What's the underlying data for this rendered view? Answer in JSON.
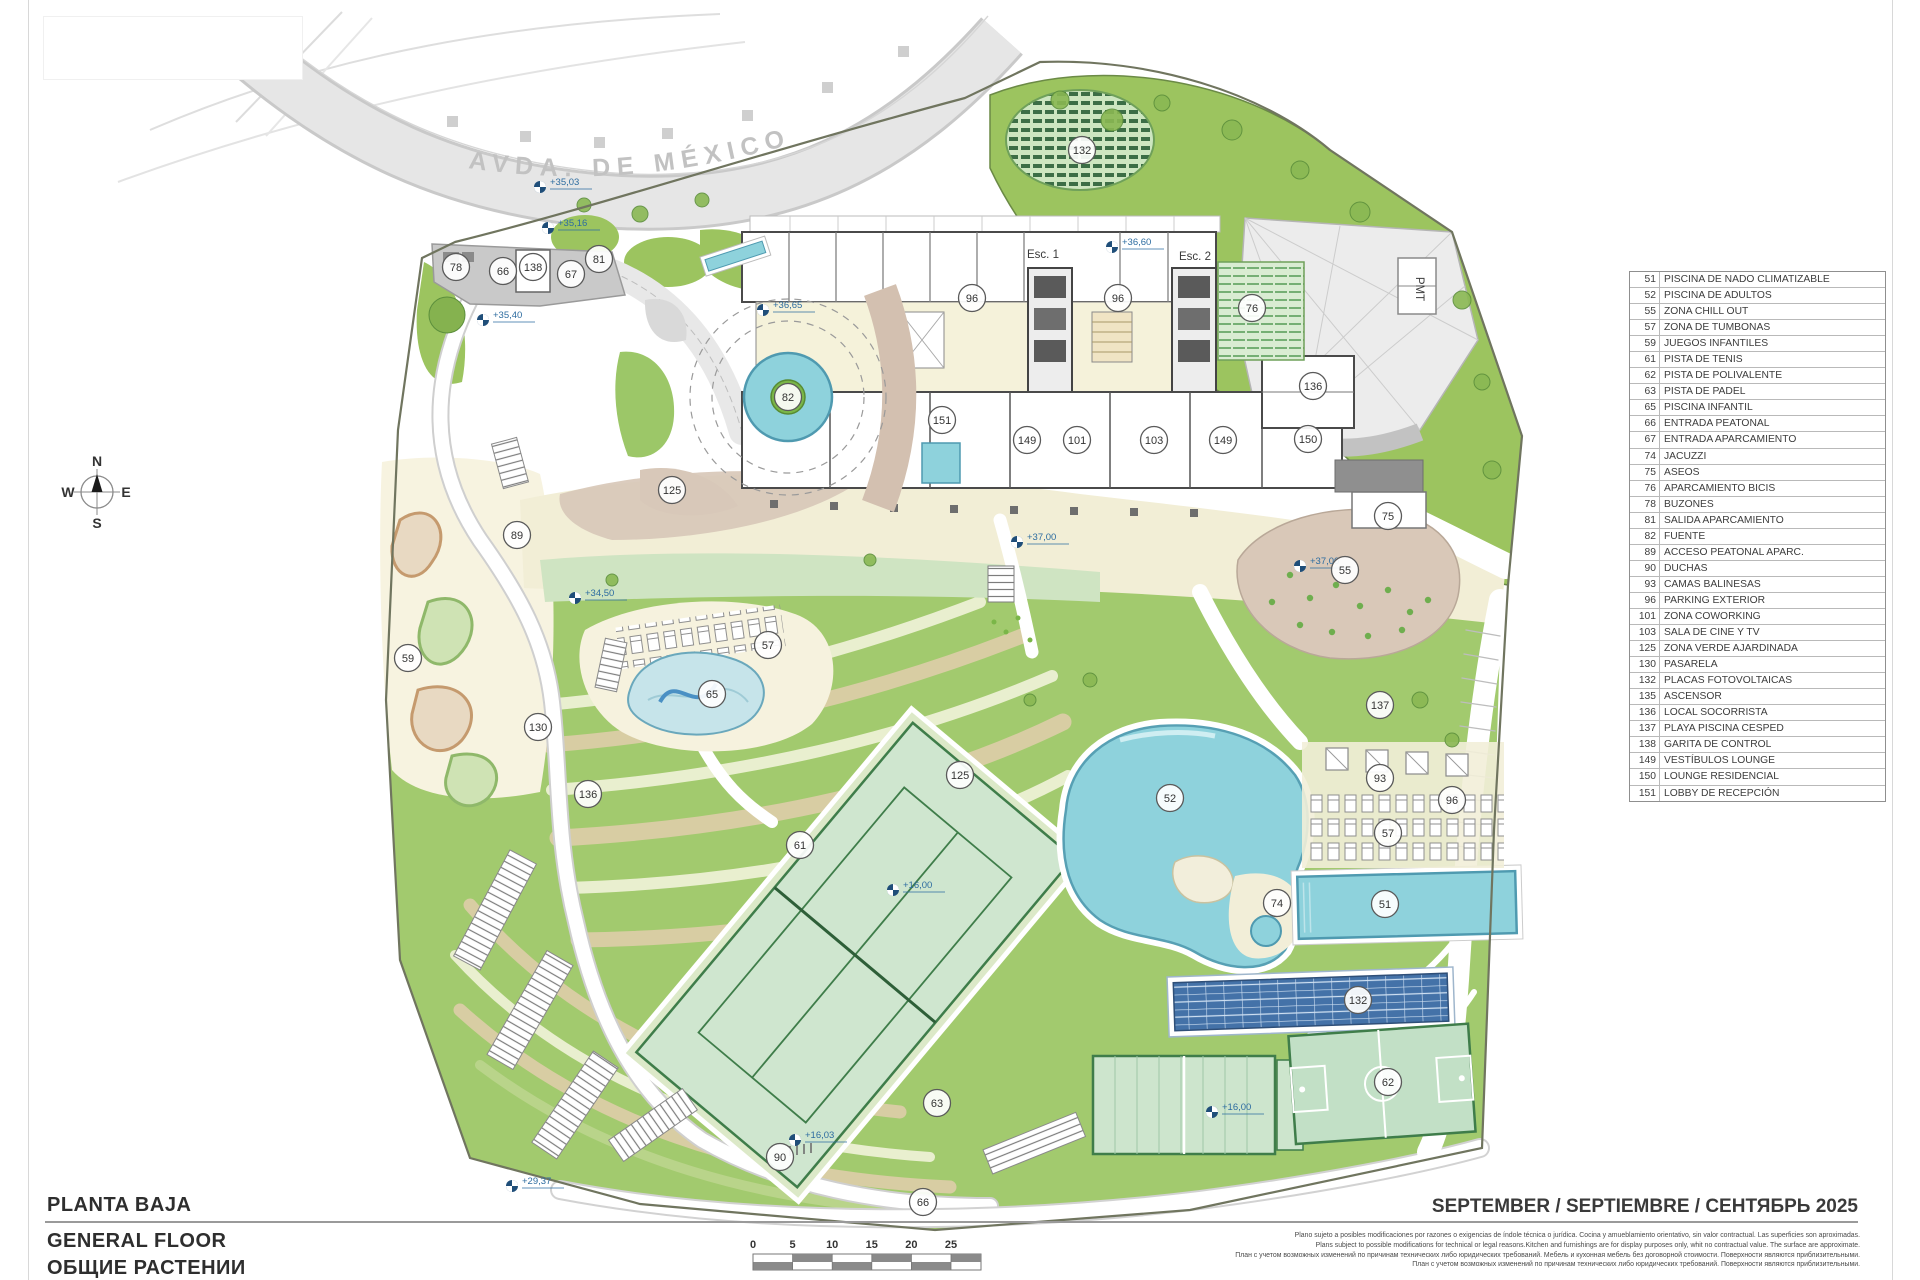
{
  "page": {
    "title_es": "PLANTA BAJA",
    "title_en": "GENERAL FLOOR",
    "title_ru": "ОБЩИЕ РАСТЕНИИ",
    "date_line": "SEPTEMBER / SEPTIEMBRE / СЕНТЯБРЬ 2025",
    "disclaimer_lines": [
      "Plano sujeto a posibles modificaciones por razones o exigencias de índole técnica o jurídica. Cocina y amueblamiento orientativo, sin valor contractual. Las superficies son aproximadas.",
      "Plans subject to possible modifications for technical or legal reasons.Kitchen and furnishings are for display purposes only, whit no contractual value. The surface are approximate.",
      "План с учетом возможных изменений по причинам технических либо юридических требований. Мебель и кухонная мебель без договорной стоимости. Поверхности являются приблизительными.",
      "План с учетом возможных изменений по причинам технических либо юридических требований. Поверхности являются приблизительными."
    ]
  },
  "road": {
    "name": "AVDA. DE MÉXICO"
  },
  "compass": {
    "n": "N",
    "e": "E",
    "s": "S",
    "w": "W"
  },
  "scale": {
    "labels": [
      "0",
      "5",
      "10",
      "15",
      "20",
      "25"
    ]
  },
  "legend": {
    "items": [
      {
        "num": "51",
        "label": "PISCINA DE NADO CLIMATIZABLE"
      },
      {
        "num": "52",
        "label": "PISCINA DE ADULTOS"
      },
      {
        "num": "55",
        "label": "ZONA CHILL OUT"
      },
      {
        "num": "57",
        "label": "ZONA DE TUMBONAS"
      },
      {
        "num": "59",
        "label": "JUEGOS INFANTILES"
      },
      {
        "num": "61",
        "label": "PISTA DE TENIS"
      },
      {
        "num": "62",
        "label": "PISTA DE POLIVALENTE"
      },
      {
        "num": "63",
        "label": "PISTA DE PADEL"
      },
      {
        "num": "65",
        "label": "PISCINA INFANTIL"
      },
      {
        "num": "66",
        "label": "ENTRADA PEATONAL"
      },
      {
        "num": "67",
        "label": "ENTRADA APARCAMIENTO"
      },
      {
        "num": "74",
        "label": "JACUZZI"
      },
      {
        "num": "75",
        "label": "ASEOS"
      },
      {
        "num": "76",
        "label": "APARCAMIENTO BICIS"
      },
      {
        "num": "78",
        "label": "BUZONES"
      },
      {
        "num": "81",
        "label": "SALIDA APARCAMIENTO"
      },
      {
        "num": "82",
        "label": "FUENTE"
      },
      {
        "num": "89",
        "label": "ACCESO PEATONAL APARC."
      },
      {
        "num": "90",
        "label": "DUCHAS"
      },
      {
        "num": "93",
        "label": "CAMAS BALINESAS"
      },
      {
        "num": "96",
        "label": "PARKING EXTERIOR"
      },
      {
        "num": "101",
        "label": "ZONA COWORKING"
      },
      {
        "num": "103",
        "label": "SALA DE CINE Y TV"
      },
      {
        "num": "125",
        "label": "ZONA VERDE AJARDINADA"
      },
      {
        "num": "130",
        "label": "PASARELA"
      },
      {
        "num": "132",
        "label": "PLACAS FOTOVOLTAICAS"
      },
      {
        "num": "135",
        "label": "ASCENSOR"
      },
      {
        "num": "136",
        "label": "LOCAL SOCORRISTA"
      },
      {
        "num": "137",
        "label": "PLAYA PISCINA CESPED"
      },
      {
        "num": "138",
        "label": "GARITA DE CONTROL"
      },
      {
        "num": "149",
        "label": "VESTÍBULOS LOUNGE"
      },
      {
        "num": "150",
        "label": "LOUNGE RESIDENCIAL"
      },
      {
        "num": "151",
        "label": "LOBBY DE RECEPCIÓN"
      }
    ]
  },
  "plan": {
    "building_labels": [
      {
        "text": "Esc. 1",
        "x": 1043,
        "y": 258,
        "rot": 0
      },
      {
        "text": "Esc. 2",
        "x": 1195,
        "y": 260,
        "rot": 0
      },
      {
        "text": "PMT",
        "x": 1416,
        "y": 289,
        "rot": 90
      }
    ],
    "markers": [
      {
        "n": "78",
        "x": 456,
        "y": 267
      },
      {
        "n": "66",
        "x": 503,
        "y": 271
      },
      {
        "n": "138",
        "x": 533,
        "y": 267
      },
      {
        "n": "67",
        "x": 571,
        "y": 274
      },
      {
        "n": "81",
        "x": 599,
        "y": 259
      },
      {
        "n": "96",
        "x": 972,
        "y": 298
      },
      {
        "n": "96",
        "x": 1118,
        "y": 298
      },
      {
        "n": "76",
        "x": 1252,
        "y": 308
      },
      {
        "n": "132",
        "x": 1082,
        "y": 150
      },
      {
        "n": "136",
        "x": 1313,
        "y": 386
      },
      {
        "n": "151",
        "x": 942,
        "y": 420
      },
      {
        "n": "149",
        "x": 1027,
        "y": 440
      },
      {
        "n": "101",
        "x": 1077,
        "y": 440
      },
      {
        "n": "103",
        "x": 1154,
        "y": 440
      },
      {
        "n": "149",
        "x": 1223,
        "y": 440
      },
      {
        "n": "150",
        "x": 1308,
        "y": 439
      },
      {
        "n": "82",
        "x": 788,
        "y": 397
      },
      {
        "n": "125",
        "x": 672,
        "y": 490
      },
      {
        "n": "89",
        "x": 517,
        "y": 535
      },
      {
        "n": "130",
        "x": 538,
        "y": 727
      },
      {
        "n": "136",
        "x": 588,
        "y": 794
      },
      {
        "n": "59",
        "x": 408,
        "y": 658
      },
      {
        "n": "75",
        "x": 1388,
        "y": 516
      },
      {
        "n": "55",
        "x": 1345,
        "y": 570
      },
      {
        "n": "57",
        "x": 768,
        "y": 645
      },
      {
        "n": "65",
        "x": 712,
        "y": 694
      },
      {
        "n": "137",
        "x": 1380,
        "y": 705
      },
      {
        "n": "93",
        "x": 1380,
        "y": 778
      },
      {
        "n": "96",
        "x": 1452,
        "y": 800
      },
      {
        "n": "57",
        "x": 1388,
        "y": 833
      },
      {
        "n": "125",
        "x": 960,
        "y": 775
      },
      {
        "n": "52",
        "x": 1170,
        "y": 798
      },
      {
        "n": "61",
        "x": 800,
        "y": 845
      },
      {
        "n": "74",
        "x": 1277,
        "y": 903
      },
      {
        "n": "51",
        "x": 1385,
        "y": 904
      },
      {
        "n": "132",
        "x": 1358,
        "y": 1000
      },
      {
        "n": "63",
        "x": 937,
        "y": 1103
      },
      {
        "n": "62",
        "x": 1388,
        "y": 1082
      },
      {
        "n": "90",
        "x": 780,
        "y": 1157
      },
      {
        "n": "66",
        "x": 923,
        "y": 1202
      }
    ],
    "levels": [
      {
        "t": "+35,03",
        "x": 540,
        "y": 187
      },
      {
        "t": "+35,16",
        "x": 548,
        "y": 228
      },
      {
        "t": "+35,40",
        "x": 483,
        "y": 320
      },
      {
        "t": "+36,65",
        "x": 763,
        "y": 310
      },
      {
        "t": "+36,60",
        "x": 1112,
        "y": 247
      },
      {
        "t": "+34,50",
        "x": 575,
        "y": 598
      },
      {
        "t": "+37,00",
        "x": 1017,
        "y": 542
      },
      {
        "t": "+37,00",
        "x": 1300,
        "y": 566
      },
      {
        "t": "+16,00",
        "x": 893,
        "y": 890
      },
      {
        "t": "+16,00",
        "x": 1212,
        "y": 1112
      },
      {
        "t": "+16,03",
        "x": 795,
        "y": 1140
      },
      {
        "t": "+29,37",
        "x": 512,
        "y": 1186
      }
    ]
  },
  "colors": {
    "grass": "#a2ca6e",
    "grass_dark": "#6b8a46",
    "pool": "#8ed2dc",
    "pool_edge": "#4f9ab0",
    "cream": "#f2eed6",
    "tan": "#d8c8b9",
    "terrace_tan": "#d8cda3",
    "terrace_pale": "#e9efcf",
    "court": "#cfe6cf",
    "court_line": "#3f7d4a",
    "road": "#e4e4e4",
    "plaza": "#c9c9c9",
    "solar": "#4472a8",
    "marker_blue": "#2d6ca0",
    "wall": "#4a4a4a"
  }
}
